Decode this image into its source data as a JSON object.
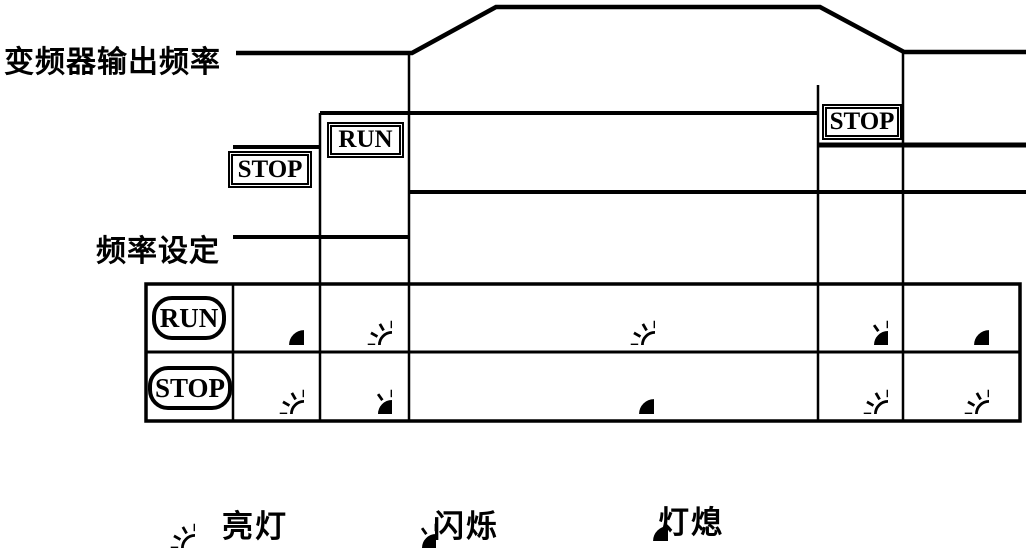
{
  "labels": {
    "output_frequency": "变频器输出频率",
    "frequency_setting": "频率设定"
  },
  "keys": {
    "stop_first": "STOP",
    "run": "RUN",
    "stop_second": "STOP"
  },
  "led_table": {
    "rows": [
      {
        "key_label": "RUN",
        "states": [
          "off",
          "lit",
          "lit",
          "flash",
          "off"
        ]
      },
      {
        "key_label": "STOP",
        "states": [
          "lit",
          "flash",
          "off",
          "lit",
          "lit"
        ]
      }
    ]
  },
  "legend": {
    "items": [
      {
        "icon": "lit",
        "label": "亮灯"
      },
      {
        "icon": "flash",
        "label": "闪烁"
      },
      {
        "icon": "off",
        "label": "灯熄"
      }
    ]
  },
  "colors": {
    "ink": "#000000",
    "background": "#ffffff"
  }
}
